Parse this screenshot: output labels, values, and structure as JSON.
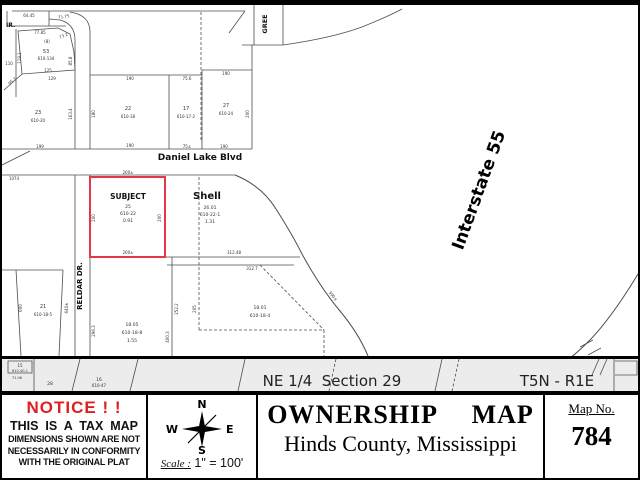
{
  "colors": {
    "accent_red": "#e02020",
    "parcel_red": "#e2384a",
    "line": "#4d4d4d",
    "map_text": "#333333",
    "band_bg": "#ececec"
  },
  "map": {
    "labels": [
      {
        "name": "dim-label",
        "t": "64.45",
        "x": 27,
        "y": 15,
        "s": 4
      },
      {
        "name": "dim-label",
        "t": "71.75",
        "x": 62,
        "y": 16,
        "s": 4,
        "r": -8
      },
      {
        "name": "street-name-partial",
        "t": "IR.",
        "x": 4,
        "y": 25,
        "s": 6,
        "a": "start",
        "w": "bold",
        "c": "#111"
      },
      {
        "name": "dim-label",
        "t": "77.85",
        "x": 38,
        "y": 32,
        "s": 4
      },
      {
        "name": "dim-label",
        "t": "73.2",
        "x": 62,
        "y": 35,
        "s": 4,
        "r": -25
      },
      {
        "name": "parcel-note",
        "t": "(8)",
        "x": 45,
        "y": 41,
        "s": 4
      },
      {
        "name": "parcel-number",
        "t": "53",
        "x": 44,
        "y": 51,
        "s": 5
      },
      {
        "name": "parcel-id",
        "t": "610-134",
        "x": 44,
        "y": 58,
        "s": 4
      },
      {
        "name": "dim-label",
        "t": "119.1",
        "x": 19,
        "y": 56,
        "s": 4,
        "r": -90
      },
      {
        "name": "dim-label",
        "t": "110",
        "x": 7,
        "y": 63,
        "s": 4
      },
      {
        "name": "dim-label",
        "t": "85.8",
        "x": 70,
        "y": 59,
        "s": 4,
        "r": -90
      },
      {
        "name": "dim-label",
        "t": "125",
        "x": 46,
        "y": 70,
        "s": 4
      },
      {
        "name": "dim-label",
        "t": "129",
        "x": 50,
        "y": 78,
        "s": 4
      },
      {
        "name": "dim-label",
        "t": "95.7",
        "x": 11,
        "y": 80,
        "s": 4,
        "r": -40
      },
      {
        "name": "parcel-number",
        "t": "23",
        "x": 36,
        "y": 112,
        "s": 5
      },
      {
        "name": "parcel-id",
        "t": "610-20",
        "x": 36,
        "y": 120,
        "s": 4
      },
      {
        "name": "dim-label",
        "t": "163.4",
        "x": 70,
        "y": 112,
        "s": 4,
        "r": -90
      },
      {
        "name": "dim-label",
        "t": "199",
        "x": 38,
        "y": 146,
        "s": 4
      },
      {
        "name": "dim-label",
        "t": "190",
        "x": 128,
        "y": 78,
        "s": 4
      },
      {
        "name": "dim-label",
        "t": "75.6",
        "x": 185,
        "y": 78,
        "s": 4
      },
      {
        "name": "dim-label",
        "t": "190",
        "x": 224,
        "y": 73,
        "s": 4
      },
      {
        "name": "parcel-number",
        "t": "22",
        "x": 126,
        "y": 108,
        "s": 5
      },
      {
        "name": "parcel-id",
        "t": "610-18",
        "x": 126,
        "y": 116,
        "s": 4
      },
      {
        "name": "dim-label",
        "t": "180",
        "x": 93,
        "y": 112,
        "s": 4,
        "r": -90
      },
      {
        "name": "parcel-number",
        "t": "17",
        "x": 184,
        "y": 108,
        "s": 5
      },
      {
        "name": "parcel-id",
        "t": "610-17-2",
        "x": 184,
        "y": 116,
        "s": 4
      },
      {
        "name": "parcel-number",
        "t": "27",
        "x": 224,
        "y": 105,
        "s": 5
      },
      {
        "name": "parcel-id",
        "t": "610-24",
        "x": 224,
        "y": 113,
        "s": 4
      },
      {
        "name": "dim-label",
        "t": "200",
        "x": 247,
        "y": 112,
        "s": 4,
        "r": -90
      },
      {
        "name": "dim-label",
        "t": "190",
        "x": 128,
        "y": 145,
        "s": 4
      },
      {
        "name": "dim-label",
        "t": "75±",
        "x": 185,
        "y": 146,
        "s": 4
      },
      {
        "name": "dim-label",
        "t": "190",
        "x": 222,
        "y": 146,
        "s": 4
      },
      {
        "name": "street-name-daniel-lake",
        "t": "Daniel Lake Blvd",
        "x": 198,
        "y": 158,
        "s": 9,
        "w": "bold",
        "c": "#111"
      },
      {
        "name": "street-name-partial-green",
        "t": "GREE",
        "x": 265,
        "y": 22,
        "s": 6.5,
        "r": -90,
        "w": "bold",
        "c": "#111"
      },
      {
        "name": "dim-label",
        "t": "200±",
        "x": 126,
        "y": 172,
        "s": 4
      },
      {
        "name": "subject-label",
        "t": "SUBJECT",
        "x": 126,
        "y": 197,
        "s": 7.5,
        "w": "bold",
        "c": "#111"
      },
      {
        "name": "subject-parcel-number",
        "t": "25",
        "x": 126,
        "y": 206,
        "s": 4.5
      },
      {
        "name": "subject-parcel-id",
        "t": "610-22",
        "x": 126,
        "y": 213,
        "s": 4.5
      },
      {
        "name": "subject-acreage",
        "t": "0.91",
        "x": 126,
        "y": 220,
        "s": 4.5
      },
      {
        "name": "dim-label",
        "t": "200",
        "x": 93,
        "y": 216,
        "s": 4,
        "r": -90
      },
      {
        "name": "dim-label",
        "t": "200",
        "x": 159,
        "y": 216,
        "s": 4,
        "r": -90
      },
      {
        "name": "dim-label",
        "t": "200±",
        "x": 126,
        "y": 252,
        "s": 4
      },
      {
        "name": "shell-label",
        "t": "Shell",
        "x": 205,
        "y": 197,
        "s": 10,
        "w": "bold",
        "c": "#111"
      },
      {
        "name": "shell-parcel-number",
        "t": "26.01",
        "x": 208,
        "y": 207,
        "s": 4.5
      },
      {
        "name": "shell-parcel-id",
        "t": "610-22-1",
        "x": 208,
        "y": 214,
        "s": 4.5
      },
      {
        "name": "shell-acreage",
        "t": "1.31",
        "x": 208,
        "y": 221,
        "s": 4.5
      },
      {
        "name": "dim-label",
        "t": "1074",
        "x": 12,
        "y": 178,
        "s": 4
      },
      {
        "name": "dim-label",
        "t": "312.48",
        "x": 232,
        "y": 252,
        "s": 4
      },
      {
        "name": "dim-label",
        "t": "312.7",
        "x": 250,
        "y": 268,
        "s": 4
      },
      {
        "name": "dim-label",
        "t": "590±",
        "x": 330,
        "y": 295,
        "s": 4,
        "r": 50
      },
      {
        "name": "street-name-reldar",
        "t": "RELDAR DR.",
        "x": 80,
        "y": 284,
        "s": 7,
        "r": -90,
        "w": "bold",
        "c": "#111"
      },
      {
        "name": "dim-label",
        "t": "640±",
        "x": 66,
        "y": 306,
        "s": 4,
        "r": -90
      },
      {
        "name": "parcel-number",
        "t": "21",
        "x": 41,
        "y": 306,
        "s": 5
      },
      {
        "name": "parcel-id",
        "t": "610-18-5",
        "x": 41,
        "y": 314,
        "s": 4
      },
      {
        "name": "dim-label",
        "t": "600",
        "x": 20,
        "y": 306,
        "s": 4,
        "r": -90
      },
      {
        "name": "dim-label",
        "t": "296.3",
        "x": 93,
        "y": 329,
        "s": 4,
        "r": -90
      },
      {
        "name": "parcel-number",
        "t": "18.05",
        "x": 130,
        "y": 324,
        "s": 4.5
      },
      {
        "name": "parcel-id",
        "t": "610-18-8",
        "x": 130,
        "y": 332,
        "s": 4.5
      },
      {
        "name": "parcel-acreage",
        "t": "1.55",
        "x": 130,
        "y": 340,
        "s": 4.5
      },
      {
        "name": "dim-label",
        "t": "400.3",
        "x": 167,
        "y": 335,
        "s": 4,
        "r": -90
      },
      {
        "name": "dim-label",
        "t": "252.2",
        "x": 176,
        "y": 307,
        "s": 4,
        "r": -90
      },
      {
        "name": "dim-label",
        "t": "205",
        "x": 194,
        "y": 307,
        "s": 4,
        "r": -90
      },
      {
        "name": "parcel-number",
        "t": "18.01",
        "x": 258,
        "y": 307,
        "s": 4.5
      },
      {
        "name": "parcel-id",
        "t": "610-18-4",
        "x": 258,
        "y": 315,
        "s": 4.5
      },
      {
        "name": "interstate-55-label",
        "t": "Interstate 55",
        "x": 482,
        "y": 190,
        "s": 17,
        "r": -70,
        "w": "bold",
        "c": "#000"
      },
      {
        "name": "parcel-number",
        "t": "15",
        "x": 18,
        "y": 365,
        "s": 4
      },
      {
        "name": "parcel-id",
        "t": "610-40-1",
        "x": 18,
        "y": 370,
        "s": 3.5
      },
      {
        "name": "dim-label",
        "t": "71.06",
        "x": 15,
        "y": 377,
        "s": 3.5
      },
      {
        "name": "parcel-number",
        "t": "28",
        "x": 48,
        "y": 383,
        "s": 4.5
      },
      {
        "name": "parcel-number",
        "t": "16",
        "x": 97,
        "y": 379,
        "s": 4.5
      },
      {
        "name": "parcel-id",
        "t": "610-47",
        "x": 97,
        "y": 385,
        "s": 4
      },
      {
        "name": "section-label",
        "t": "NE 1/4  Section 29",
        "x": 330,
        "y": 384,
        "s": 15,
        "c": "#222"
      },
      {
        "name": "township-label",
        "t": "T5N - R1E",
        "x": 555,
        "y": 384,
        "s": 15,
        "c": "#222"
      }
    ]
  },
  "panel": {
    "notice": {
      "title": "NOTICE ! !",
      "line1": "THIS  IS  A  TAX  MAP",
      "line2": "DIMENSIONS SHOWN ARE NOT",
      "line3": "NECESSARILY IN CONFORMITY",
      "line4": "WITH THE ORIGINAL PLAT"
    },
    "compass": {
      "n": "N",
      "e": "E",
      "s": "S",
      "w": "W"
    },
    "scale": {
      "label": "Scale :",
      "value": " 1\" = 100'"
    },
    "title": "OWNERSHIP  MAP",
    "subtitle": "Hinds County, Mississippi",
    "map_no_label": "Map No.",
    "map_no": "784"
  }
}
